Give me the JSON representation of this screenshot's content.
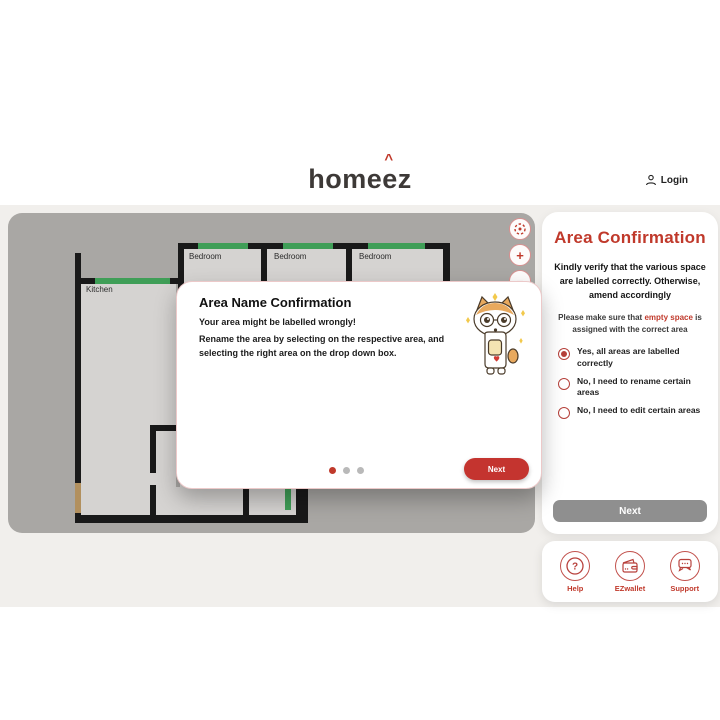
{
  "header": {
    "logo_text": "hom",
    "logo_e1": "e",
    "logo_e2": "e",
    "logo_z": "z",
    "login_label": "Login"
  },
  "canvas": {
    "controls": {
      "zoom_in": "+",
      "zoom_out": "−"
    },
    "rooms": {
      "kitchen": "Kitchen",
      "bedroom1": "Bedroom",
      "bedroom2": "Bedroom",
      "bedroom3": "Bedroom"
    }
  },
  "modal": {
    "title": "Area Name Confirmation",
    "line1": "Your area might be labelled wrongly!",
    "line2": "Rename the area by selecting on the respective area, and selecting the right area on the drop down box.",
    "next_label": "Next"
  },
  "sidebar": {
    "title": "Area Confirmation",
    "body": "Kindly verify that the various space are labelled correctly. Otherwise, amend accordingly",
    "note_prefix": "Please make sure that ",
    "note_highlight": "empty space",
    "note_suffix": " is assigned with the correct area",
    "options": [
      {
        "label": "Yes, all areas are labelled correctly",
        "selected": true
      },
      {
        "label": "No, I need to rename certain areas",
        "selected": false
      },
      {
        "label": "No, I need to edit certain areas",
        "selected": false
      }
    ],
    "next_label": "Next"
  },
  "footer_panel": {
    "items": [
      {
        "label": "Help"
      },
      {
        "label": "EZwallet"
      },
      {
        "label": "Support"
      }
    ]
  },
  "colors": {
    "accent_red": "#c0392b",
    "canvas_gray": "#a9a7a4",
    "room_floor": "#d5d3d1",
    "window_green": "#3f9e57",
    "door_tan": "#b2905e",
    "next_gray": "#8f8f8f"
  }
}
